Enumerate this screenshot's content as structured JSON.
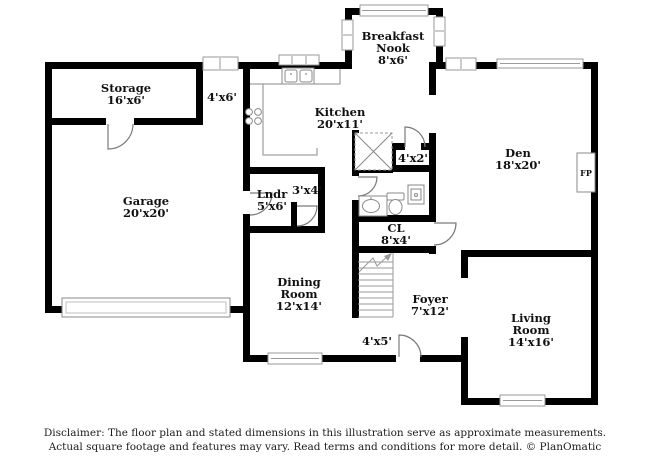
{
  "rooms": [
    {
      "id": "storage",
      "lines": [
        "Storage",
        "16'x6'"
      ]
    },
    {
      "id": "hall-closet",
      "lines": [
        "4'x6'"
      ]
    },
    {
      "id": "breakfast-nook",
      "lines": [
        "Breakfast",
        "Nook",
        "8'x6'"
      ]
    },
    {
      "id": "kitchen",
      "lines": [
        "Kitchen",
        "20'x11'"
      ]
    },
    {
      "id": "closet-4x2",
      "lines": [
        "4'x2'"
      ]
    },
    {
      "id": "den",
      "lines": [
        "Den",
        "18'x20'"
      ]
    },
    {
      "id": "fireplace",
      "lines": [
        "FP"
      ]
    },
    {
      "id": "laundry",
      "lines": [
        "Lndr",
        "5'x6'"
      ]
    },
    {
      "id": "closet-3x4",
      "lines": [
        "3'x4'"
      ]
    },
    {
      "id": "garage",
      "lines": [
        "Garage",
        "20'x20'"
      ]
    },
    {
      "id": "closet-cl",
      "lines": [
        "CL",
        "8'x4'"
      ]
    },
    {
      "id": "dining-room",
      "lines": [
        "Dining",
        "Room",
        "12'x14'"
      ]
    },
    {
      "id": "foyer",
      "lines": [
        "Foyer",
        "7'x12'"
      ]
    },
    {
      "id": "entry",
      "lines": [
        "4'x5'"
      ]
    },
    {
      "id": "living-room",
      "lines": [
        "Living",
        "Room",
        "14'x16'"
      ]
    }
  ],
  "footer": {
    "line1": "Disclaimer: The floor plan and stated dimensions in this illustration serve as approximate measurements.",
    "line2": "Actual square footage and features may vary. Read terms and conditions for more detail. © PlanOmatic"
  },
  "colors": {
    "wall": "#000000",
    "window_outline": "#9a9a9a",
    "door_swing": "#7a7a7a",
    "fixture_outline": "#8a8a8a",
    "text": "#111111",
    "background": "#ffffff"
  }
}
